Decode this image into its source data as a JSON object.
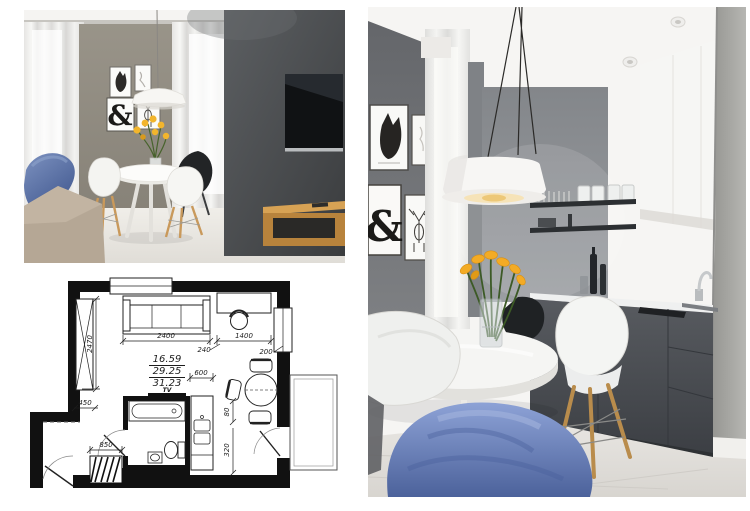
{
  "collage": {
    "background": "#ffffff",
    "panels": [
      "living-room-photo",
      "floor-plan",
      "kitchen-photo"
    ]
  },
  "living_room_photo": {
    "ampersand_art": "&",
    "palette": {
      "feature_wall": "#46484b",
      "side_wall": "#8f8b86",
      "wood_shelf": "#bd8840",
      "blue_armchair": "#5b74a8",
      "sofa": "#b5a795",
      "flowers": "#efb32b",
      "floor": "#e9e6e1",
      "tv_screen": "#14161a"
    }
  },
  "kitchen_photo": {
    "ampersand_art": "&",
    "palette": {
      "left_wall": "#75777b",
      "back_wall": "#8d9094",
      "upper_cabinets": "#f6f6f4",
      "lower_cabinets": "#45484d",
      "counter": "#eff0f0",
      "blue_chair": "#6e86c0",
      "flowers": "#f2a825",
      "floor": "#e2dfda"
    }
  },
  "floor_plan": {
    "tv_label": "TV",
    "areas": {
      "line1": "16.59",
      "line2": "29.25",
      "line3": "31.23"
    },
    "dims": {
      "wall_left": "2470",
      "sofa": "2400",
      "sofa_desk_gap": "240",
      "desk": "1400",
      "desk_wall_gap": "200",
      "passage": "450",
      "counter": "600",
      "table_gap": "80",
      "door_offset": "320",
      "radiator": "850"
    }
  }
}
